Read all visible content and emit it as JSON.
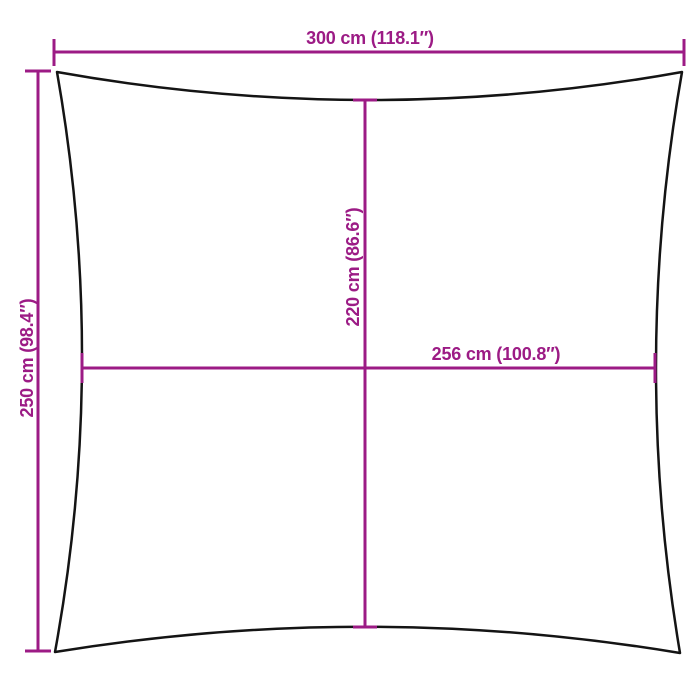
{
  "diagram": {
    "kind": "product-dimension-diagram",
    "product_shape": "square-shade-sail-concave-edges",
    "colors": {
      "dimension": "#9c1b85",
      "outline": "#141414",
      "background": "#ffffff"
    },
    "dimensions": {
      "overall_width": {
        "label": "300 cm (118.1″)",
        "position": "top"
      },
      "overall_height": {
        "label": "250 cm (98.4″)",
        "position": "left"
      },
      "inner_height": {
        "label": "220 cm (86.6″)",
        "position": "center-vertical"
      },
      "inner_width": {
        "label": "256 cm (100.8″)",
        "position": "center-horizontal"
      }
    }
  }
}
